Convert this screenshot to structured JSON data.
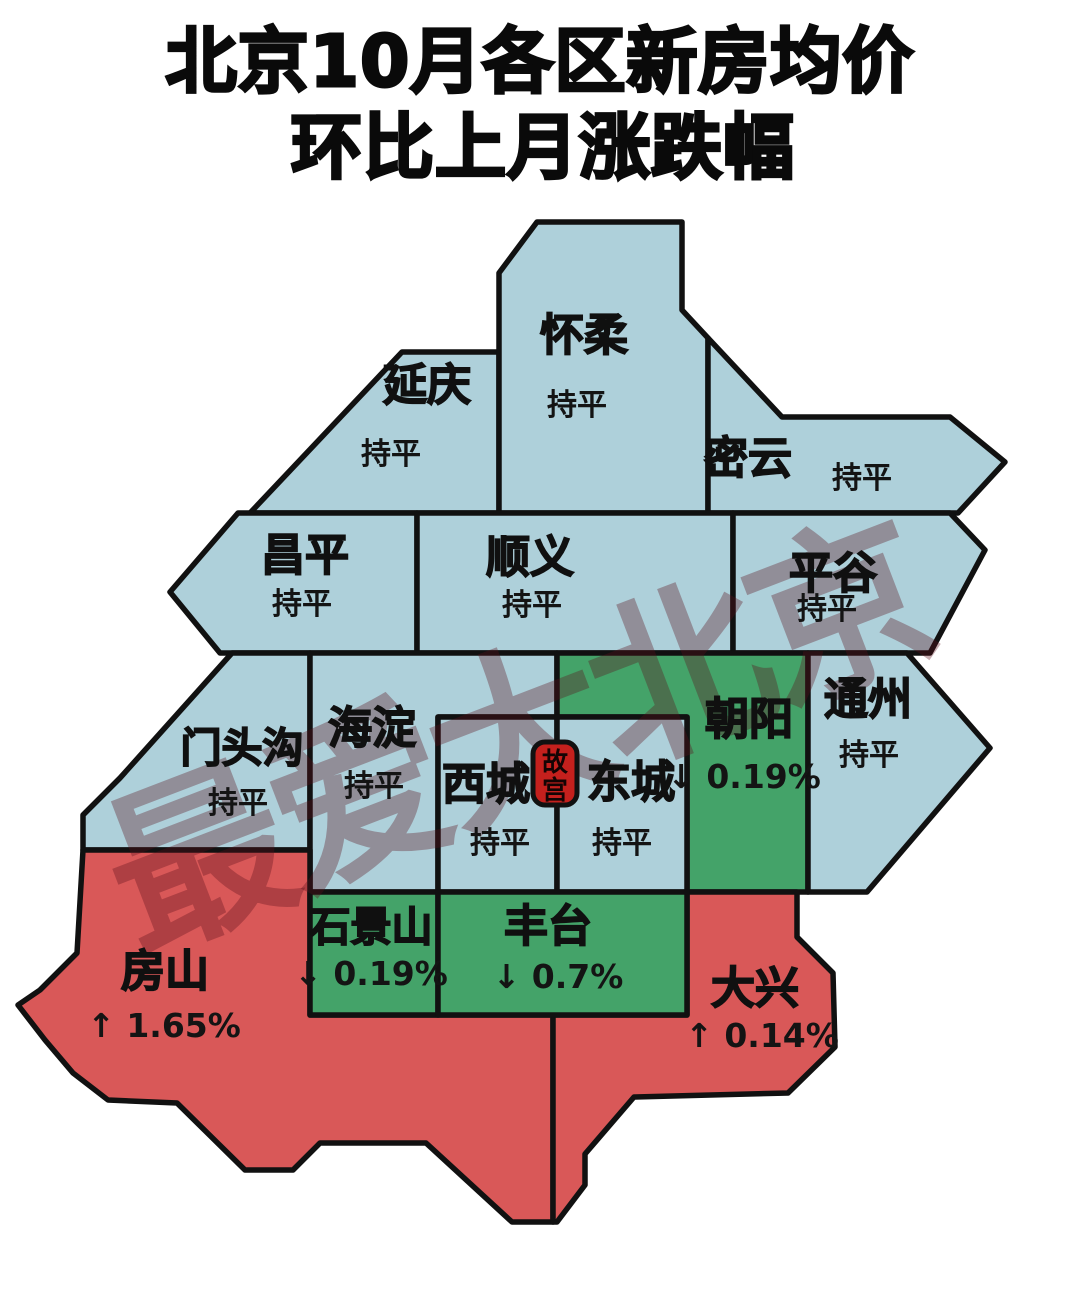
{
  "title": {
    "line1": "北京10月各区新房均价",
    "line2": "环比上月涨跌幅"
  },
  "watermark": {
    "text": "最爱大北京"
  },
  "landmark": {
    "name": "故宫",
    "char_top": "故",
    "char_bottom": "宫"
  },
  "palette": {
    "flat_blue": "#aed0da",
    "down_green": "#44a369",
    "up_red": "#d95858",
    "landmark_red": "#c4201d",
    "outline": "#111111"
  },
  "districts": [
    {
      "id": "yanqing",
      "name": "延庆",
      "value": "持平",
      "trend": "flat"
    },
    {
      "id": "huairou",
      "name": "怀柔",
      "value": "持平",
      "trend": "flat"
    },
    {
      "id": "miyun",
      "name": "密云",
      "value": "持平",
      "trend": "flat"
    },
    {
      "id": "changping",
      "name": "昌平",
      "value": "持平",
      "trend": "flat"
    },
    {
      "id": "shunyi",
      "name": "顺义",
      "value": "持平",
      "trend": "flat"
    },
    {
      "id": "pinggu",
      "name": "平谷",
      "value": "持平",
      "trend": "flat"
    },
    {
      "id": "mentougou",
      "name": "门头沟",
      "value": "持平",
      "trend": "flat"
    },
    {
      "id": "haidian",
      "name": "海淀",
      "value": "持平",
      "trend": "flat"
    },
    {
      "id": "xicheng",
      "name": "西城",
      "value": "持平",
      "trend": "flat"
    },
    {
      "id": "dongcheng",
      "name": "东城",
      "value": "持平",
      "trend": "flat"
    },
    {
      "id": "chaoyang",
      "name": "朝阳",
      "value": "↓ 0.19%",
      "trend": "down"
    },
    {
      "id": "tongzhou",
      "name": "通州",
      "value": "持平",
      "trend": "flat"
    },
    {
      "id": "shijingshan",
      "name": "石景山",
      "value": "↓ 0.19%",
      "trend": "down"
    },
    {
      "id": "fengtai",
      "name": "丰台",
      "value": "↓ 0.7%",
      "trend": "down"
    },
    {
      "id": "fangshan",
      "name": "房山",
      "value": "↑ 1.65%",
      "trend": "up"
    },
    {
      "id": "daxing",
      "name": "大兴",
      "value": "↑ 0.14%",
      "trend": "up"
    }
  ]
}
